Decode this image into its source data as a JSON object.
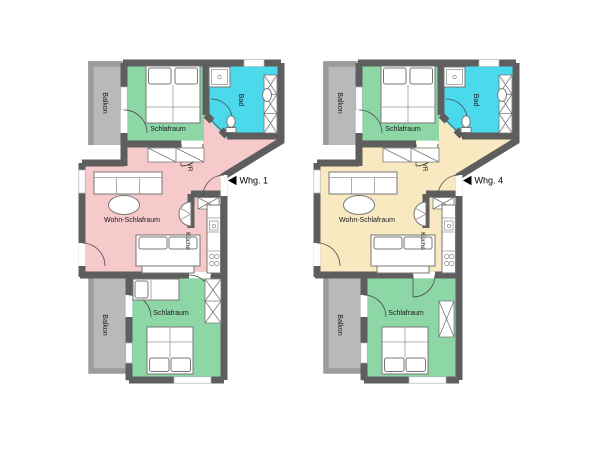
{
  "colors": {
    "background": "#ffffff",
    "wall": "#5e5e5e",
    "balcony_wall": "#9c9c9c",
    "balcony": "#b9b9b9",
    "bedroom": "#8dd6a6",
    "bath": "#4bd9ec",
    "label": "#1a1a1a"
  },
  "apartments": [
    {
      "name": "Whg. 1",
      "accent": "#f6c9ca",
      "rooms": {
        "balcony_top": "Balkon",
        "bedroom_top": "Schlafraum",
        "bath": "Bad",
        "hall": "VR",
        "living": "Wohn-Schlafraum",
        "kitchen": "Küche",
        "bedroom_bottom": "Schlafraum",
        "balcony_bottom": "Balkon"
      }
    },
    {
      "name": "Whg. 4",
      "accent": "#f8e9c0",
      "rooms": {
        "balcony_top": "Balkon",
        "bedroom_top": "Schlafraum",
        "bath": "Bad",
        "hall": "VR",
        "living": "Wohn-Schlafraum",
        "kitchen": "Küche",
        "bedroom_bottom": "Schlafraum",
        "balcony_bottom": "Balkon"
      }
    }
  ]
}
